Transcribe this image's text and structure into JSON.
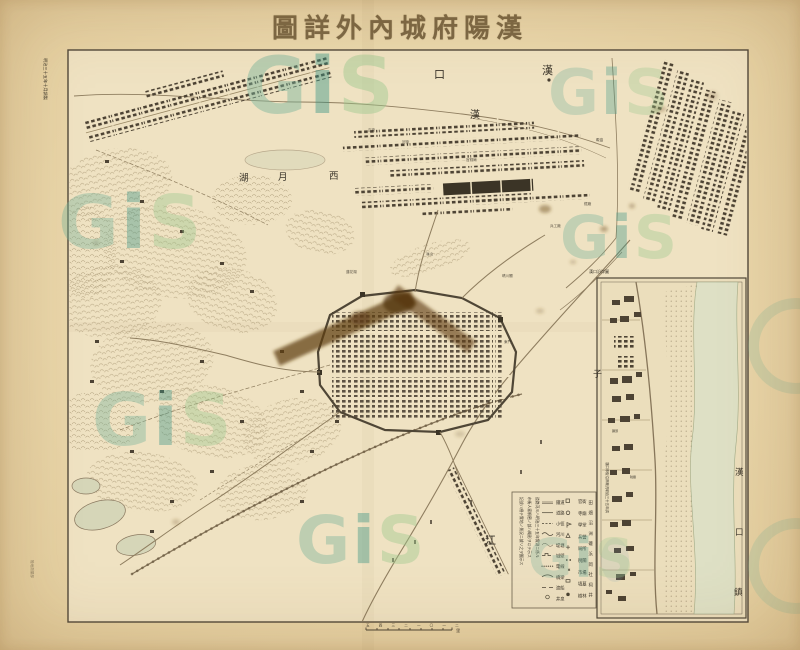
{
  "title": {
    "text": "漢陽府城內外詳圖",
    "display": "圖詳外內城府陽漢"
  },
  "margin": {
    "left_note": "明治三十五年十月調製",
    "left_note2": "陸地測量部",
    "scale_marks": "五 四 三 二 一 〇 一 二",
    "scale_unit": "里"
  },
  "watermark": {
    "g": "G",
    "i": "i",
    "s": "S",
    "color_g": "#79b49c",
    "color_i": "#3f9787",
    "color_s": "#9cc88e"
  },
  "map_labels": {
    "hankou_kou": "口",
    "hankou_han": "漢",
    "hanshui_han": "漢",
    "xi": "西",
    "yue": "月",
    "hu": "湖",
    "zi": "子",
    "jiang": "江"
  },
  "micro": [
    "正街",
    "河街",
    "官錢局",
    "礮臺",
    "兵工廠",
    "鐵廠",
    "龜山",
    "晴川閣",
    "蓮花湖",
    "東門"
  ],
  "inset": {
    "river_label": [
      "漢",
      "口",
      "鎮"
    ],
    "top_note": "漢口沿岸圖",
    "side_note": "漢口市街沿岸概況明治三十五年調",
    "micro": [
      "碼頭",
      "稅關"
    ]
  },
  "legend": {
    "notes": [
      "記號ハ總テ實地ノ景況ニ據リ之ヲ圖示ス",
      "市街人家稠密ノ部ハ概形ヲ以テ示ス",
      "道路河川ハ明治三十五年實測ニ係ル"
    ],
    "colA": [
      {
        "label": "鐵道"
      },
      {
        "label": "道路"
      },
      {
        "label": "小徑"
      },
      {
        "label": "河川"
      },
      {
        "label": "堤塘"
      },
      {
        "label": "城壁"
      },
      {
        "label": "電線"
      },
      {
        "label": "橋梁"
      },
      {
        "label": "渡船"
      },
      {
        "label": "井泉"
      }
    ],
    "colB": [
      {
        "label": "官衙"
      },
      {
        "label": "寺廟"
      },
      {
        "label": "學堂"
      },
      {
        "label": "兵營"
      },
      {
        "label": "局所"
      },
      {
        "label": "稅關"
      },
      {
        "label": "市場"
      },
      {
        "label": "墳墓"
      },
      {
        "label": "樹林"
      }
    ],
    "colC": [
      "田",
      "畑",
      "沼",
      "洲",
      "磯",
      "浜",
      "岡",
      "社",
      "祠",
      "井"
    ],
    "colors": {
      "paper": "#eee0c2",
      "line": "#8a795c",
      "block": "#4d4334"
    }
  }
}
